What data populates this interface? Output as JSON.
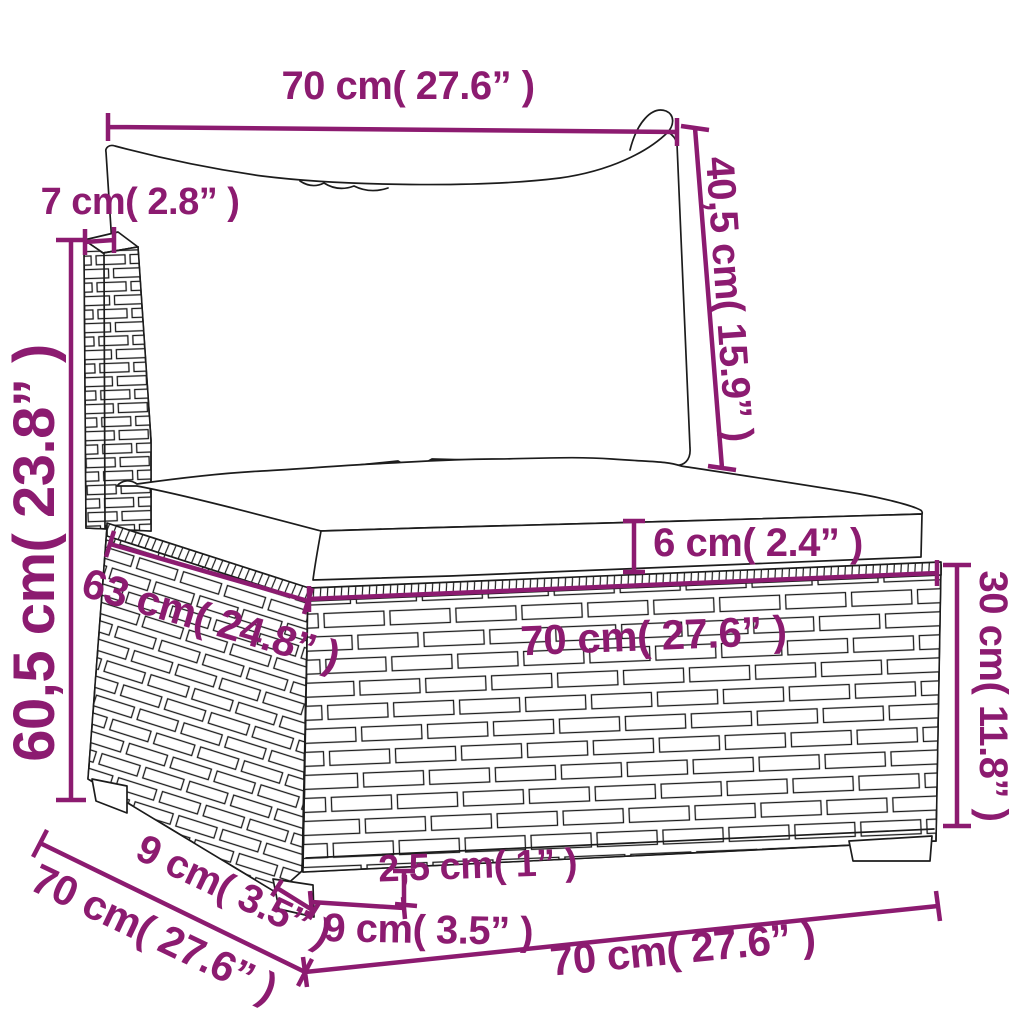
{
  "diagram": {
    "kind": "product-dimension-drawing",
    "subject": "rattan-sofa-section-with-cushions",
    "colors": {
      "dimension_accent": "#8C1B70",
      "outline": "#1c1c1c",
      "background": "#ffffff"
    },
    "labels": {
      "back_cushion_width": "70 cm( 27.6” )",
      "back_cushion_height": "40,5 cm( 15.9” )",
      "back_panel_thickness": "7 cm( 2.8” )",
      "total_height": "60,5 cm( 23.8” )",
      "seat_top_depth": "63 cm( 24.8” )",
      "seat_cushion_thickness": "6 cm( 2.4” )",
      "seat_front_width": "70 cm( 27.6” )",
      "base_height": "30 cm( 11.8” )",
      "leg_depth": "9 cm( 3.5” )",
      "overall_depth": "70 cm( 27.6” )",
      "leg_height": "2,5 cm( 1” )",
      "leg_width": "9 cm( 3.5” )",
      "overall_width": "70 cm( 27.6” )"
    }
  }
}
